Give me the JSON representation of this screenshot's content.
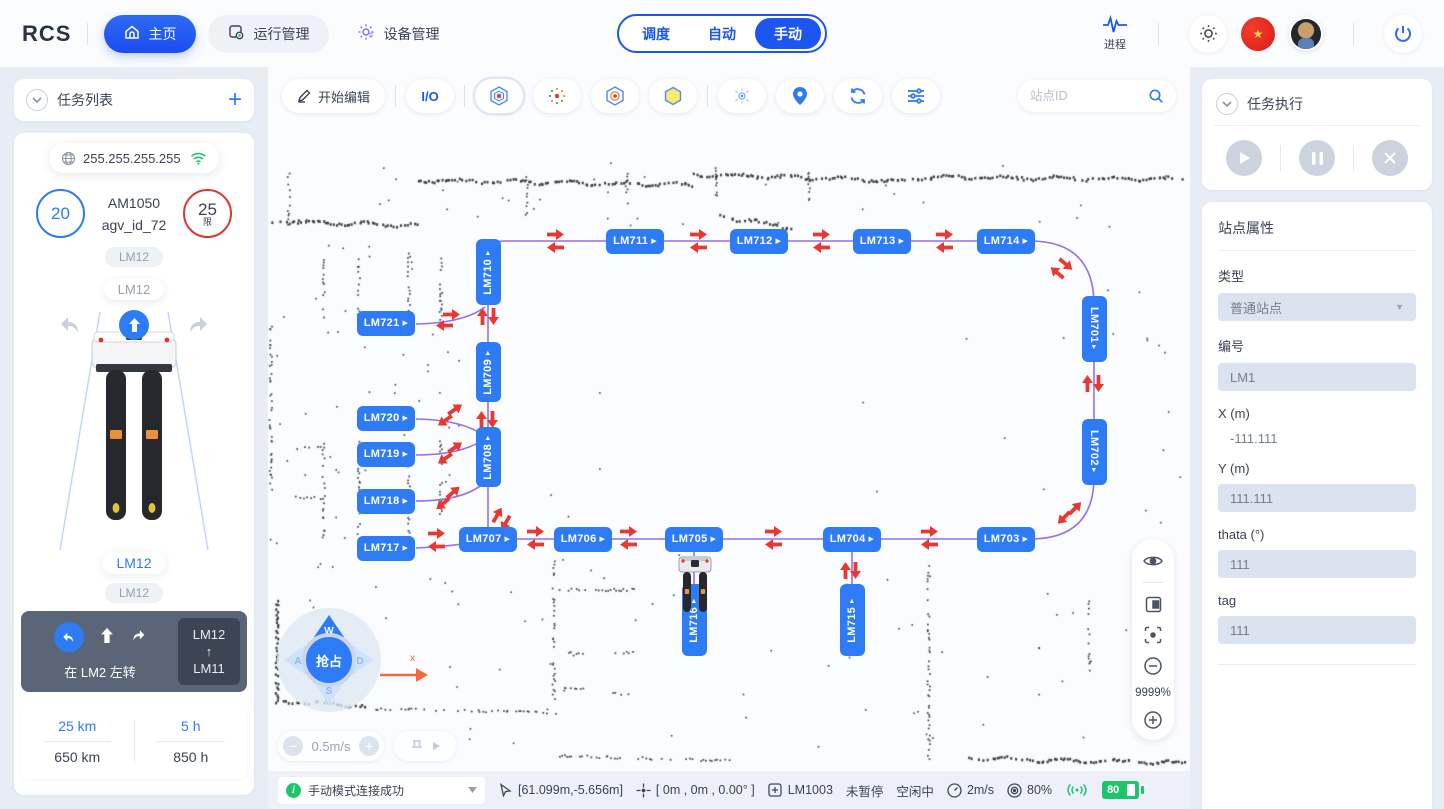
{
  "topbar": {
    "logo": "RCS",
    "nav": [
      {
        "label": "主页"
      },
      {
        "label": "运行管理"
      },
      {
        "label": "设备管理"
      }
    ],
    "modes": [
      {
        "label": "调度"
      },
      {
        "label": "自动"
      },
      {
        "label": "手动"
      }
    ],
    "process_label": "进程"
  },
  "left": {
    "header": "任务列表",
    "ip": "255.255.255.255",
    "battery_circle": "20",
    "speed_limit": "25",
    "speed_limit_sub": "限",
    "model": "AM1050",
    "agv_id": "agv_id_72",
    "tag1": "LM12",
    "tag2": "LM12",
    "tag3": "LM12",
    "tag4": "LM12",
    "nav_hint": {
      "text": "在 LM2 左转",
      "from": "LM12",
      "to": "LM11"
    },
    "stats": {
      "trip_km": "25 km",
      "total_km": "650 km",
      "trip_h": "5 h",
      "total_h": "850 h"
    }
  },
  "map": {
    "toolbar": {
      "edit": "开始编辑",
      "io": "I/O",
      "search_placeholder": "站点ID"
    },
    "joystick": {
      "center": "抢占",
      "up": "W",
      "left": "A",
      "down": "S",
      "right": "D"
    },
    "speed_label": "0.5m/s",
    "zoom_label": "9999%",
    "axis_label": "x",
    "stations": [
      {
        "id": "LM711",
        "x": 367,
        "y": 174,
        "o": "h"
      },
      {
        "id": "LM712",
        "x": 491,
        "y": 174,
        "o": "h"
      },
      {
        "id": "LM713",
        "x": 614,
        "y": 174,
        "o": "h"
      },
      {
        "id": "LM714",
        "x": 738,
        "y": 174,
        "o": "h"
      },
      {
        "id": "LM721",
        "x": 118,
        "y": 256,
        "o": "h"
      },
      {
        "id": "LM720",
        "x": 118,
        "y": 351,
        "o": "h"
      },
      {
        "id": "LM719",
        "x": 118,
        "y": 387,
        "o": "h"
      },
      {
        "id": "LM718",
        "x": 118,
        "y": 434,
        "o": "h"
      },
      {
        "id": "LM717",
        "x": 118,
        "y": 481,
        "o": "h"
      },
      {
        "id": "LM707",
        "x": 220,
        "y": 472,
        "o": "h"
      },
      {
        "id": "LM706",
        "x": 315,
        "y": 472,
        "o": "h"
      },
      {
        "id": "LM705",
        "x": 426,
        "y": 472,
        "o": "h"
      },
      {
        "id": "LM704",
        "x": 584,
        "y": 472,
        "o": "h"
      },
      {
        "id": "LM703",
        "x": 738,
        "y": 472,
        "o": "h"
      },
      {
        "id": "LM710",
        "x": 220,
        "y": 205,
        "o": "v",
        "a": "up",
        "len": 66
      },
      {
        "id": "LM709",
        "x": 220,
        "y": 305,
        "o": "v",
        "a": "up",
        "len": 60
      },
      {
        "id": "LM708",
        "x": 220,
        "y": 390,
        "o": "v",
        "a": "up",
        "len": 60
      },
      {
        "id": "LM701",
        "x": 826,
        "y": 262,
        "o": "v",
        "a": "down",
        "len": 66
      },
      {
        "id": "LM702",
        "x": 826,
        "y": 385,
        "o": "v",
        "a": "down",
        "len": 66
      },
      {
        "id": "LM716",
        "x": 426,
        "y": 553,
        "o": "v",
        "a": "up",
        "len": 72
      },
      {
        "id": "LM715",
        "x": 584,
        "y": 553,
        "o": "v",
        "a": "up",
        "len": 72
      }
    ],
    "routes": [
      "M220 472 L220 188 Q220 174 236 174 L762 174 Q826 174 826 238 L826 410 Q826 472 762 472 Z",
      "M148 257 Q196 256 217 240",
      "M148 352 Q196 353 216 369",
      "M148 388 Q192 388 215 373",
      "M148 434 Q198 434 218 414",
      "M148 481 Q190 479 218 473",
      "M426 485 L426 552",
      "M584 485 L584 552"
    ],
    "arrows": [
      [
        287,
        166,
        0
      ],
      [
        287,
        181,
        180
      ],
      [
        430,
        166,
        0
      ],
      [
        430,
        181,
        180
      ],
      [
        553,
        166,
        0
      ],
      [
        553,
        181,
        180
      ],
      [
        676,
        166,
        0
      ],
      [
        676,
        181,
        180
      ],
      [
        798,
        196,
        40
      ],
      [
        788,
        206,
        220
      ],
      [
        818,
        316,
        -90
      ],
      [
        831,
        316,
        90
      ],
      [
        806,
        440,
        -45
      ],
      [
        796,
        451,
        135
      ],
      [
        267,
        463,
        0
      ],
      [
        267,
        478,
        180
      ],
      [
        360,
        463,
        0
      ],
      [
        360,
        478,
        180
      ],
      [
        505,
        463,
        0
      ],
      [
        505,
        478,
        180
      ],
      [
        661,
        463,
        0
      ],
      [
        661,
        478,
        180
      ],
      [
        168,
        465,
        0
      ],
      [
        168,
        480,
        180
      ],
      [
        576,
        503,
        -90
      ],
      [
        588,
        503,
        90
      ],
      [
        213,
        249,
        -90
      ],
      [
        226,
        249,
        90
      ],
      [
        212,
        352,
        -90
      ],
      [
        225,
        352,
        90
      ],
      [
        183,
        246,
        0
      ],
      [
        176,
        259,
        180
      ],
      [
        186,
        341,
        -35
      ],
      [
        177,
        354,
        145
      ],
      [
        186,
        379,
        -35
      ],
      [
        177,
        392,
        145
      ],
      [
        184,
        424,
        -40
      ],
      [
        175,
        437,
        140
      ],
      [
        228,
        447,
        -60
      ],
      [
        238,
        456,
        120
      ]
    ],
    "walls": [
      [
        150,
        112,
        425,
        117,
        1
      ],
      [
        425,
        106,
        638,
        113,
        1
      ],
      [
        640,
        109,
        915,
        111,
        1
      ],
      [
        2,
        153,
        148,
        157,
        1
      ],
      [
        20,
        106,
        20,
        163,
        0
      ],
      [
        258,
        108,
        258,
        148,
        0
      ],
      [
        358,
        106,
        358,
        142,
        0
      ],
      [
        452,
        148,
        525,
        160,
        1
      ],
      [
        448,
        100,
        448,
        130,
        0
      ],
      [
        540,
        104,
        540,
        140,
        0
      ],
      [
        55,
        193,
        55,
        256,
        0
      ],
      [
        90,
        190,
        90,
        256,
        0
      ],
      [
        140,
        186,
        140,
        260,
        0
      ],
      [
        172,
        190,
        172,
        256,
        0
      ],
      [
        2,
        255,
        2,
        425,
        0
      ],
      [
        55,
        376,
        55,
        470,
        0
      ],
      [
        90,
        374,
        90,
        470,
        0
      ],
      [
        140,
        372,
        140,
        468,
        0
      ],
      [
        172,
        374,
        172,
        452,
        0
      ],
      [
        28,
        380,
        52,
        380,
        0
      ],
      [
        100,
        377,
        128,
        377,
        0
      ],
      [
        28,
        430,
        52,
        430,
        0
      ],
      [
        100,
        430,
        128,
        430,
        0
      ],
      [
        8,
        532,
        8,
        638,
        1
      ],
      [
        15,
        633,
        100,
        638,
        1
      ],
      [
        102,
        641,
        288,
        645,
        0
      ],
      [
        285,
        494,
        285,
        640,
        0
      ],
      [
        290,
        522,
        368,
        522,
        0
      ],
      [
        295,
        585,
        315,
        585,
        0
      ],
      [
        345,
        585,
        365,
        585,
        0
      ],
      [
        295,
        620,
        315,
        620,
        0
      ],
      [
        345,
        626,
        365,
        626,
        0
      ],
      [
        660,
        494,
        660,
        696,
        0
      ],
      [
        820,
        532,
        820,
        614,
        0
      ],
      [
        700,
        690,
        916,
        695,
        1
      ],
      [
        290,
        688,
        470,
        693,
        0
      ]
    ],
    "colors": {
      "station": "#2e7bf6",
      "route": "#8d63e8",
      "arrow": "#e8382f",
      "wall": "#3a3f46"
    }
  },
  "right": {
    "exec_header": "任务执行",
    "props": {
      "title": "站点属性",
      "f_type_label": "类型",
      "f_type_value": "普通站点",
      "f_code_label": "编号",
      "f_code_value": "LM1",
      "f_x_label": "X (m)",
      "f_x_value": "-111.111",
      "f_y_label": "Y (m)",
      "f_y_value": "111.111",
      "f_theta_label": "thata (°)",
      "f_theta_value": "111",
      "f_tag_label": "tag",
      "f_tag_value": "111"
    }
  },
  "statusbar": {
    "message": "手动模式连接成功",
    "position": "[61.099m,-5.656m]",
    "pose": "[ 0m , 0m , 0.00° ]",
    "station": "LM1003",
    "pause_state": "未暂停",
    "idle_state": "空闲中",
    "speed": "2m/s",
    "percent": "80%",
    "battery": "80"
  }
}
